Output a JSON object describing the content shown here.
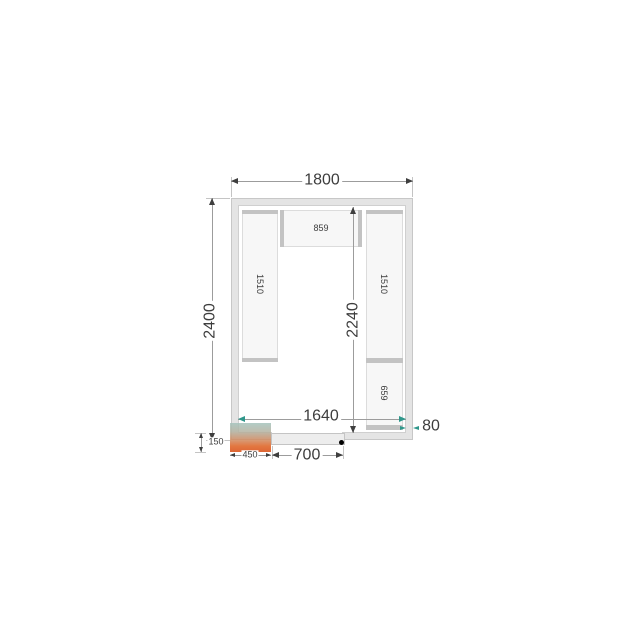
{
  "drawing": {
    "type": "cold-room-floor-plan",
    "labels": {
      "outer_width": "1800",
      "outer_depth": "2400",
      "inner_depth": "2240",
      "inner_width": "1640",
      "wall_thickness": "80",
      "unit_protrusion": "150",
      "unit_width": "450",
      "door_width": "700",
      "shelf_top": "859",
      "shelf_left": "1510",
      "shelf_right_upper": "1510",
      "shelf_right_lower": "659"
    },
    "colors": {
      "wall_fill": "#e4e4e4",
      "wall_line": "#c7c7c7",
      "shelf_fill": "#f7f7f7",
      "shelf_cap": "#c3c3c3",
      "dim_text": "#3d3d3d",
      "dim_line": "#9c9c9c",
      "accent_arrow_teal": "#2f978b",
      "unit_gradient_top": "#a4c3bc",
      "unit_gradient_bottom": "#d84a10",
      "hinge_dot": "#000000"
    }
  }
}
